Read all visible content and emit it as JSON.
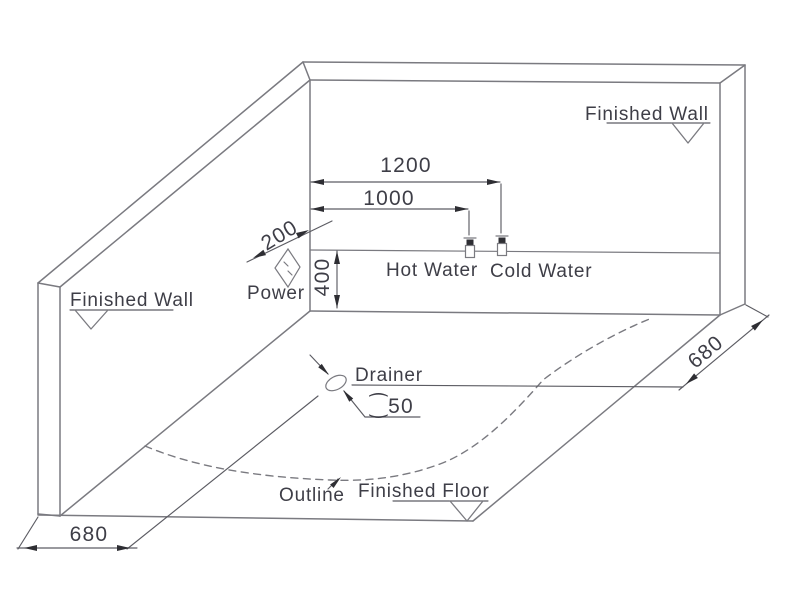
{
  "labels": {
    "finished_wall_right": "Finished Wall",
    "finished_wall_left": "Finished Wall",
    "power": "Power",
    "hot_water": "Hot Water",
    "cold_water": "Cold Water",
    "drainer": "Drainer",
    "outline": "Outline",
    "finished_floor": "Finished Floor"
  },
  "dimensions": {
    "cold_water_offset_from_corner": "1200",
    "hot_water_offset_from_corner": "1000",
    "power_offset_from_corner": "200",
    "supply_height_above_floor": "400",
    "drain_to_left_wall": "680",
    "drain_to_right_wall": "680",
    "drain_diameter": "⁐50"
  },
  "colors": {
    "background": "#ffffff",
    "line": "#7a7a80",
    "dimension": "#5c5c63",
    "text": "#3e3e47",
    "arrow": "#2e2e33"
  }
}
